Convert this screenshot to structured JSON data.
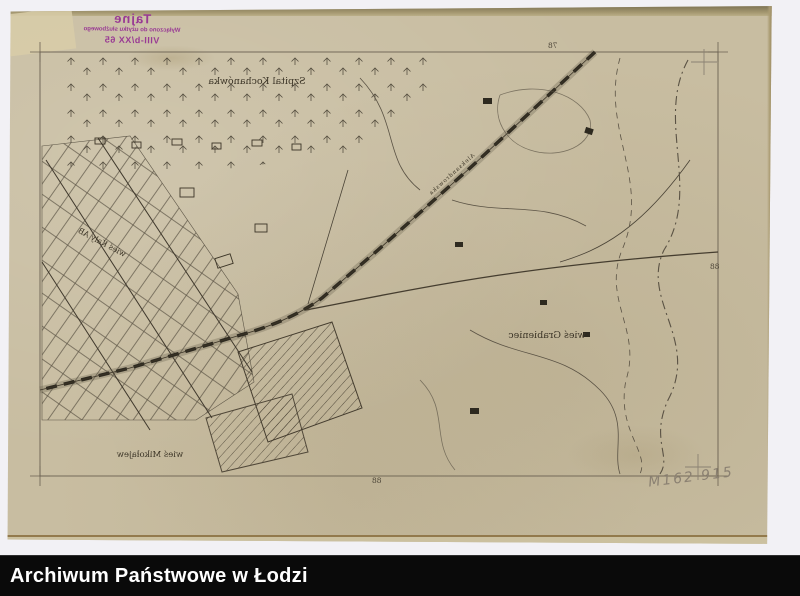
{
  "window": {
    "width": 800,
    "height": 596
  },
  "footer": {
    "label": "Archiwum Państwowe w Łodzi",
    "bg": "#0a0a0a",
    "fg": "#ffffff"
  },
  "stamp": {
    "line1": "Tajne",
    "line2": "Wyłączono do użytku służbowego",
    "line3": "VIII-b/XX 65",
    "color": "#993a94",
    "mirrored": true
  },
  "map": {
    "paper_color": "#c8bda1",
    "ink_color": "#453d2f",
    "mirrored": true,
    "labels": {
      "hospital": "Szpital Kochanówka",
      "village_kaly": "wieś Kały AB",
      "village_grabieniec": "wieś Grabieniec",
      "village_mikolajew": "wieś Mikołajew",
      "road": "Aleksandrowska"
    },
    "grid_numbers": {
      "top": "78",
      "right": "88",
      "bottom": "88"
    },
    "pencil_note": "M162 915"
  }
}
